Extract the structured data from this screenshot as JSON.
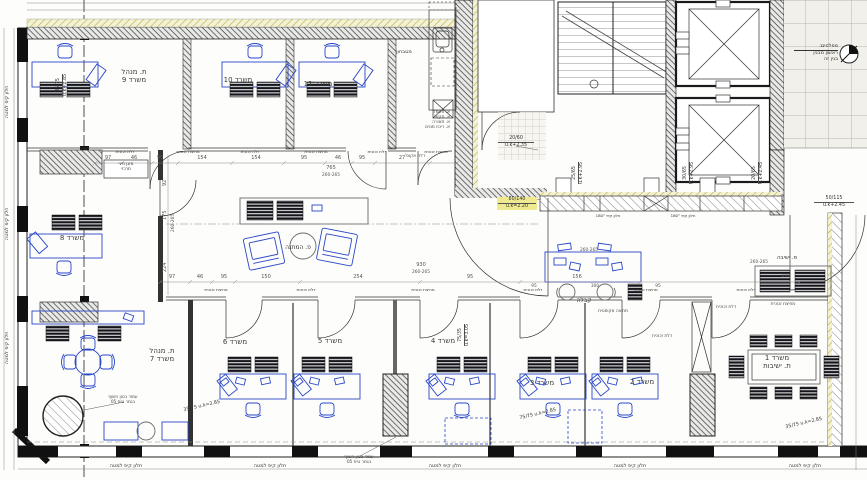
{
  "plan": {
    "rooms": {
      "office9": [
        "ת. מנהל",
        "משרד 9"
      ],
      "office10": "משרד 10",
      "office11": "משרד 11",
      "kitchenette": "מטבחון",
      "office8": "משרד 8",
      "office7": [
        "ת. מנהל",
        "משרד 7"
      ],
      "office6": "משרד 6",
      "office5": "משרד 5",
      "office4": "משרד 4",
      "office3": "משרד 3",
      "office2": "משרד 2",
      "meeting_room": [
        "משרד 1",
        "ת. ישיבות"
      ],
      "waiting_corner": "פ. המתנה",
      "reception": "קבלה",
      "sitting_corner": "פ. ישיבה"
    },
    "notes": {
      "tilt_window": "חלון קיפ למטה",
      "concrete_column": [
        "עמוד בטון חשוף",
        "בגמר טיח 05"
      ],
      "glass_door": "דלת זכוכית",
      "glass_partition": "מחיצת זכוכית",
      "acoustic_partition": "מחיצה אקוסטית",
      "acoustic_door": "דלת אקוס'",
      "band_window": "חלון קיפ 180°",
      "ac_unit": [
        "מזגן מיני",
        "מרכזי"
      ],
      "electrical_closets": [
        "א. חשמל",
        "א. תקש'",
        "א. תאורה",
        "א. ריכוז מונים"
      ],
      "levels_block": [
        "מפלסים:",
        "ראשון מבנין",
        "בנין זה"
      ]
    },
    "lintel_tags": {
      "left_wall": [
        "35/75",
        "u.k+2.85"
      ],
      "kitchen_pass": [
        "20/60",
        "u.k+2.35"
      ],
      "core_1": [
        "25/65",
        "u.k+2.95"
      ],
      "core_2": [
        "30/65",
        "u.k+2.95"
      ],
      "lobby_door": [
        "20/65",
        "u.k+2.45"
      ],
      "right_wall": [
        "50/115",
        "u.k+2.45"
      ],
      "main_entry": [
        "80/140",
        "u.k=2.20"
      ],
      "office7_win": [
        "35/75",
        "u.k=2.85"
      ],
      "office3_win": [
        "75/75",
        "u.k=2.85"
      ],
      "meeting_win": [
        "35/75",
        "u.k=2.85"
      ],
      "office4_door": [
        "75/35",
        "u.k=3.05"
      ]
    },
    "dimensions": {
      "top_total": "765",
      "top_range": "260-265",
      "top_segments": [
        "97",
        "46",
        "95",
        "154",
        "154",
        "95",
        "46",
        "95",
        "27"
      ],
      "bottom_total": "930",
      "bottom_range": "260-265",
      "bottom_segments": [
        "97",
        "46",
        "95",
        "150",
        "254",
        "95",
        "156"
      ],
      "left_segments": [
        "92",
        "175",
        "224"
      ],
      "left_range": "260-265",
      "bench_depth": "210",
      "bench_range": "260-265",
      "reception_width": "300",
      "side_95": "95"
    }
  }
}
